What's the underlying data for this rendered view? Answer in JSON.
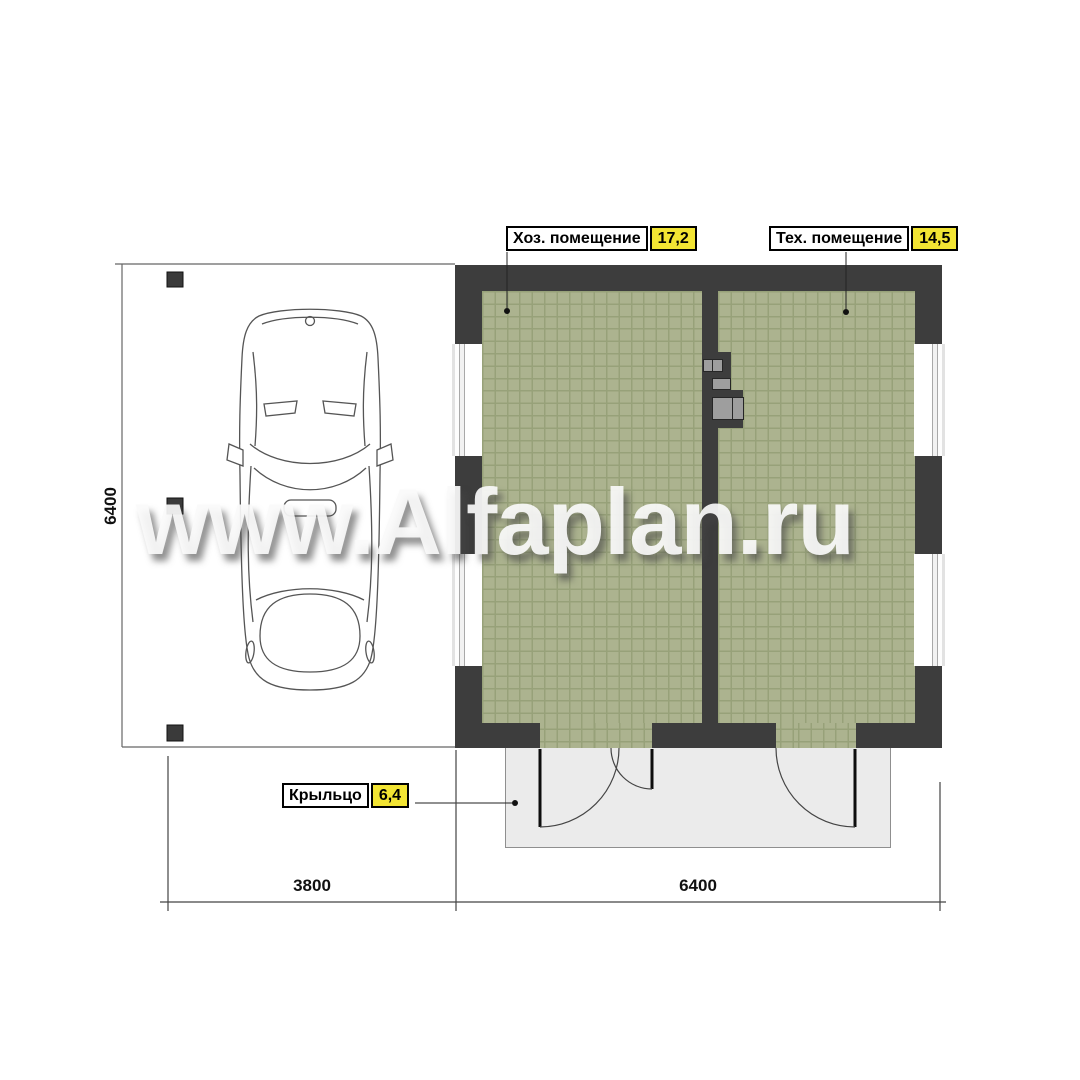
{
  "watermark": {
    "text": "www.Alfaplan.ru"
  },
  "labels": {
    "room1": {
      "name": "Хоз. помещение",
      "area": "17,2"
    },
    "room2": {
      "name": "Тех. помещение",
      "area": "14,5"
    },
    "porch": {
      "name": "Крыльцо",
      "area": "6,4"
    }
  },
  "dimensions": {
    "carport_width": "3800",
    "building_width": "6400",
    "carport_depth": "6400"
  },
  "colors": {
    "wall": "#3d3d3d",
    "floor_tile": "#acb38f",
    "tile_grout": "#97a179",
    "porch": "#ebebeb",
    "area_badge": "#f2e433",
    "linework": "#555555"
  }
}
